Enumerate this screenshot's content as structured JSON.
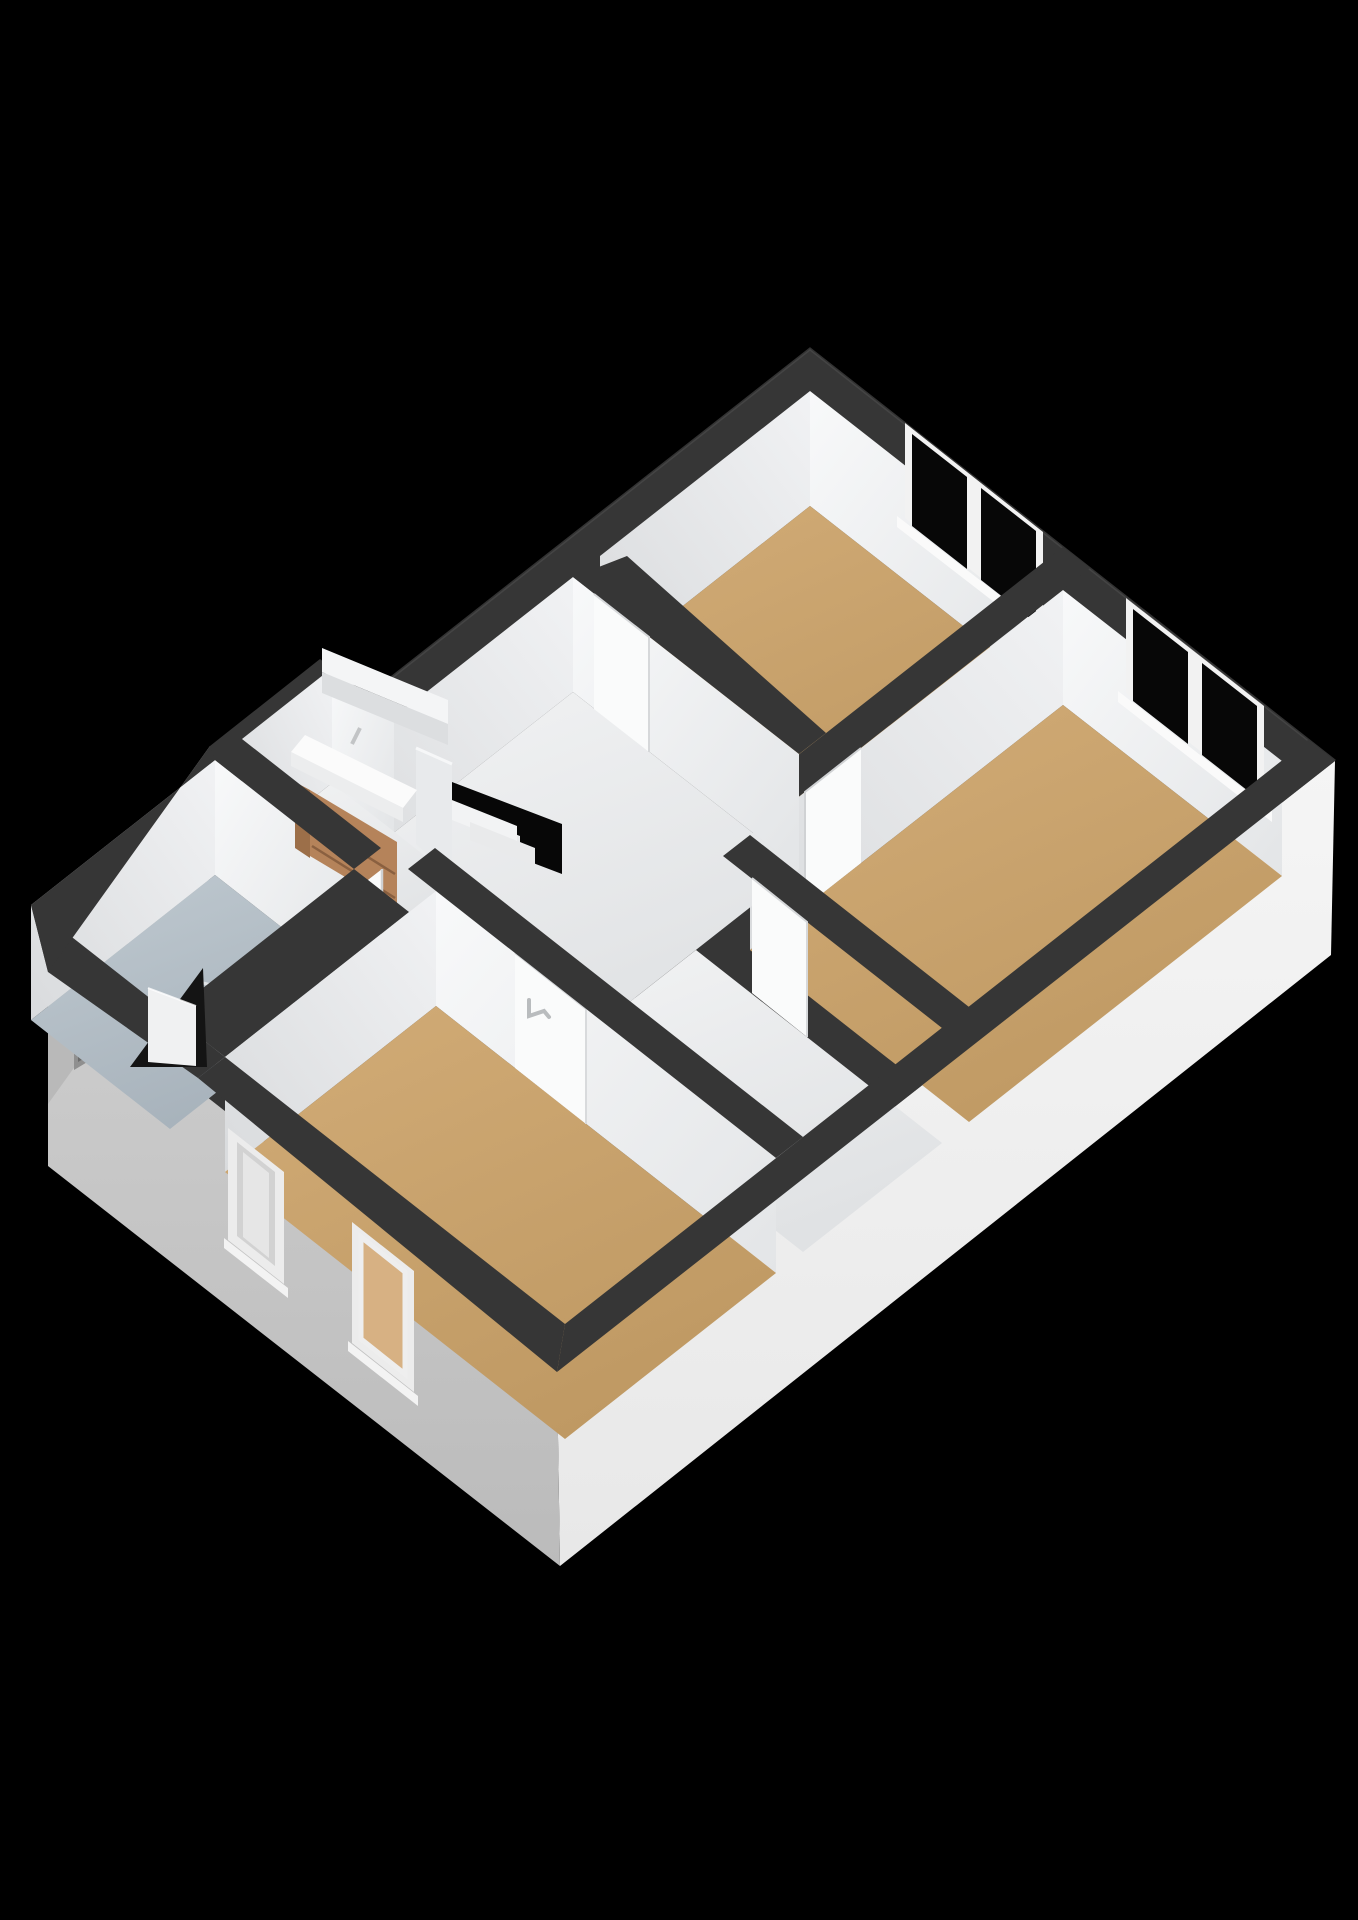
{
  "meta": {
    "description": "3D isometric floor-plan rendering of an upper storey on a black background: landing with open staircase, three bedrooms with tan floors, bathroom with vanity, toilet and glass shower screen",
    "background": "#000000"
  },
  "colors": {
    "background": "#000000",
    "band": "#363636",
    "band_dark": "#2e2e2e",
    "wall_light": "#f4f5f7",
    "wall_mid": "#e6e8ea",
    "floor_tan": "#c8a26e",
    "floor_tan2": "#cba672",
    "floor_hall": "#ecedee",
    "floor_bath": "#b5bfc7",
    "facade_white": "#f2f2f2",
    "facade_gray": "#c8c8c8",
    "facade_gray2": "#b9b9b9",
    "window_frame": "#f2f2f2",
    "glass": "#070707",
    "void": "#070707",
    "wood": "#b5835a",
    "wood_dark": "#9c6f49",
    "porcelain": "#fbfbfb",
    "railing": "#f4f5f6",
    "door_leaf": "#fafbfb",
    "handle": "#b9bcbe",
    "vent": "#8f8f8f"
  },
  "scene": {
    "type": "3d-floorplan-isometric",
    "storey": "upper floor",
    "rooms": [
      {
        "name": "bedroom-top",
        "floor": "tan",
        "windows": 1
      },
      {
        "name": "bedroom-right",
        "floor": "tan",
        "windows": 1
      },
      {
        "name": "bedroom-front",
        "floor": "tan",
        "windows": 2,
        "door": "white leaf with handle"
      },
      {
        "name": "landing",
        "floor": "white",
        "features": [
          "stairwell-void",
          "railing",
          "banister"
        ]
      },
      {
        "name": "bathroom",
        "floor": "blue-gray",
        "fixtures": [
          "vanity-wood-two-drawers",
          "washbasin",
          "toilet",
          "glass-shower-screen",
          "shower-arm"
        ]
      }
    ],
    "facades": [
      {
        "name": "front-right",
        "color": "white"
      },
      {
        "name": "front-left",
        "color": "gray",
        "windows": 2
      },
      {
        "name": "left",
        "color": "gray",
        "vent": true
      }
    ],
    "doors": [
      {
        "name": "door-top-bedroom",
        "state": "closed"
      },
      {
        "name": "door-right-bedroom",
        "state": "closed"
      },
      {
        "name": "door-hall",
        "state": "closed"
      },
      {
        "name": "door-bathroom",
        "state": "closed"
      },
      {
        "name": "door-front-bedroom",
        "state": "closed",
        "handle": true
      },
      {
        "name": "door-left-exterior",
        "state": "open"
      }
    ]
  }
}
